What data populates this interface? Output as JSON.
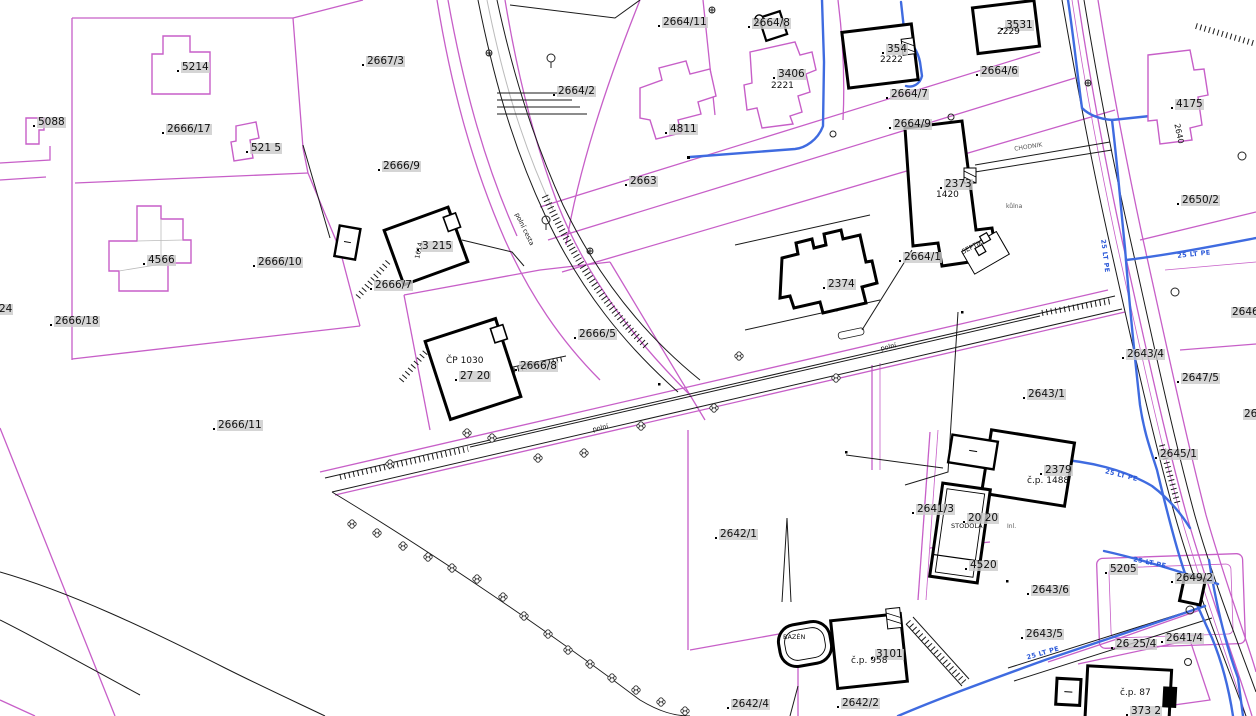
{
  "map_title": "Cadastral map",
  "colors": {
    "background": "#ffffff",
    "parcel_line": "#c75fc8",
    "boundary_line": "#1a1a1a",
    "building_line": "#000000",
    "water_line": "#3f6be0",
    "label_bg": "#cbcbcb"
  },
  "labels": [
    {
      "t": "5214",
      "x": 181,
      "y": 62
    },
    {
      "t": "5088",
      "x": 37,
      "y": 117
    },
    {
      "t": "2666/17",
      "x": 166,
      "y": 124
    },
    {
      "t": "521 5",
      "x": 250,
      "y": 143
    },
    {
      "t": "2667/3",
      "x": 366,
      "y": 56
    },
    {
      "t": "2666/9",
      "x": 382,
      "y": 161
    },
    {
      "t": "2664/11",
      "x": 662,
      "y": 17
    },
    {
      "t": "2664/8",
      "x": 752,
      "y": 18
    },
    {
      "t": "3406",
      "x": 777,
      "y": 69
    },
    {
      "t": "354",
      "x": 886,
      "y": 44
    },
    {
      "t": "3531",
      "x": 1005,
      "y": 20
    },
    {
      "t": "2664/2",
      "x": 557,
      "y": 86
    },
    {
      "t": "4811",
      "x": 669,
      "y": 124
    },
    {
      "t": "2663",
      "x": 629,
      "y": 176
    },
    {
      "t": "2664/6",
      "x": 980,
      "y": 66
    },
    {
      "t": "2664/7",
      "x": 890,
      "y": 89
    },
    {
      "t": "2664/9",
      "x": 893,
      "y": 119
    },
    {
      "t": "4175",
      "x": 1175,
      "y": 99
    },
    {
      "t": "2650/2",
      "x": 1181,
      "y": 195
    },
    {
      "t": "2373",
      "x": 944,
      "y": 179
    },
    {
      "t": "4566",
      "x": 147,
      "y": 255
    },
    {
      "t": "2666/10",
      "x": 257,
      "y": 257
    },
    {
      "t": "2666/18",
      "x": 54,
      "y": 316
    },
    {
      "t": "2666/7",
      "x": 374,
      "y": 280
    },
    {
      "t": "24",
      "x": -2,
      "y": 304,
      "d": 0
    },
    {
      "t": "3 215",
      "x": 421,
      "y": 241
    },
    {
      "t": "2666/5",
      "x": 578,
      "y": 329
    },
    {
      "t": "2666/8",
      "x": 519,
      "y": 361
    },
    {
      "t": "27 20",
      "x": 459,
      "y": 371
    },
    {
      "t": "2666/11",
      "x": 217,
      "y": 420
    },
    {
      "t": "2664/1",
      "x": 903,
      "y": 252
    },
    {
      "t": "2374",
      "x": 827,
      "y": 279
    },
    {
      "t": "2643/1",
      "x": 1027,
      "y": 389
    },
    {
      "t": "2643/4",
      "x": 1126,
      "y": 349
    },
    {
      "t": "2646/1",
      "x": 1231,
      "y": 307,
      "d": 0
    },
    {
      "t": "2647/5",
      "x": 1181,
      "y": 373
    },
    {
      "t": "26 4",
      "x": 1243,
      "y": 409,
      "d": 0
    },
    {
      "t": "2645/1",
      "x": 1159,
      "y": 449
    },
    {
      "t": "2642/1",
      "x": 719,
      "y": 529
    },
    {
      "t": "2641/3",
      "x": 916,
      "y": 504
    },
    {
      "t": "20 20",
      "x": 967,
      "y": 513
    },
    {
      "t": "4520",
      "x": 969,
      "y": 560
    },
    {
      "t": "2379",
      "x": 1044,
      "y": 465
    },
    {
      "t": "5205",
      "x": 1109,
      "y": 564
    },
    {
      "t": "2643/6",
      "x": 1031,
      "y": 585
    },
    {
      "t": "2643/5",
      "x": 1025,
      "y": 629
    },
    {
      "t": "26 25/4",
      "x": 1115,
      "y": 639
    },
    {
      "t": "2641/4",
      "x": 1165,
      "y": 633
    },
    {
      "t": "2649/2",
      "x": 1175,
      "y": 573
    },
    {
      "t": "3101",
      "x": 875,
      "y": 649
    },
    {
      "t": "2642/4",
      "x": 731,
      "y": 699
    },
    {
      "t": "2642/2",
      "x": 841,
      "y": 698
    },
    {
      "t": "373 2",
      "x": 1130,
      "y": 706
    },
    {
      "t": "2221",
      "x": 770,
      "y": 82,
      "c": "s"
    },
    {
      "t": "2222",
      "x": 879,
      "y": 56,
      "c": "s"
    },
    {
      "t": "2229",
      "x": 996,
      "y": 28,
      "c": "s"
    },
    {
      "t": "1420",
      "x": 935,
      "y": 191,
      "c": "s"
    },
    {
      "t": "č.p. 1488",
      "x": 1026,
      "y": 477,
      "c": "s"
    },
    {
      "t": "č.p. 958",
      "x": 850,
      "y": 657,
      "c": "s"
    },
    {
      "t": "č.p. 87",
      "x": 1119,
      "y": 689,
      "c": "s"
    },
    {
      "t": "ČP 1030",
      "x": 445,
      "y": 357,
      "c": "s"
    },
    {
      "t": "STODOLA",
      "x": 950,
      "y": 523,
      "c": "t"
    },
    {
      "t": "BAZÉN",
      "x": 782,
      "y": 634,
      "c": "t"
    },
    {
      "t": "SEPTIK",
      "x": 960,
      "y": 250,
      "c": "t",
      "r": -28
    },
    {
      "t": "2640",
      "x": 1180,
      "y": 122,
      "c": "s2",
      "r": 78
    },
    {
      "t": "1614",
      "x": 414,
      "y": 259,
      "c": "t",
      "r": -78
    },
    {
      "t": "kůlna",
      "x": 1005,
      "y": 204,
      "c": "g"
    },
    {
      "t": "Inl.",
      "x": 1006,
      "y": 524,
      "c": "g"
    },
    {
      "t": "polní cesta",
      "x": 519,
      "y": 211,
      "c": "t",
      "r": 64
    },
    {
      "t": "polní",
      "x": 591,
      "y": 427,
      "c": "t",
      "r": -13
    },
    {
      "t": "polní",
      "x": 879,
      "y": 346,
      "c": "t",
      "r": -13
    },
    {
      "t": "CHODNIK",
      "x": 1013,
      "y": 147,
      "c": "g",
      "r": -9
    },
    {
      "t": "25 LT PE",
      "x": 1105,
      "y": 468,
      "c": "b",
      "r": 14
    },
    {
      "t": "25 LT PE",
      "x": 1133,
      "y": 556,
      "c": "b",
      "r": 12
    },
    {
      "t": "25 LT PE",
      "x": 1025,
      "y": 655,
      "c": "b",
      "r": -16
    },
    {
      "t": "25 LT PE",
      "x": 1106,
      "y": 238,
      "c": "b",
      "r": 83
    },
    {
      "t": "25 LT PE",
      "x": 1176,
      "y": 253,
      "c": "b",
      "r": -6
    }
  ]
}
